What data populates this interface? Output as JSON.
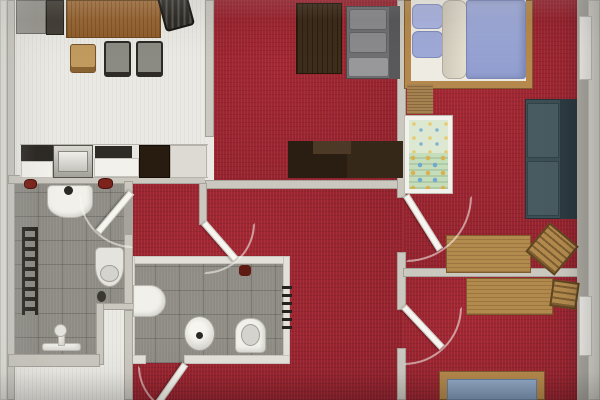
{
  "scene": {
    "type": "apartment-floor-plan-top-view",
    "canvas": {
      "w": 600,
      "h": 400
    },
    "palette": {
      "carpet_red": "#9c2430",
      "tile_gray": "#8e8c85",
      "floor_white": "#eae9e3",
      "wall": "#cbc8c0",
      "wood_light": "#b28a4e",
      "wood_dark": "#3f2d1b",
      "lavender_bedding": "#9ea9d7",
      "teal_sofa": "#3b4f55",
      "blue_mattress": "#8ba2bf"
    },
    "floors": [
      {
        "name": "kitchen-dining-floor",
        "cls": "floor-white",
        "x": 12,
        "y": 0,
        "w": 196,
        "h": 178
      },
      {
        "name": "living-room-floor",
        "cls": "carpet-red",
        "x": 208,
        "y": 0,
        "w": 195,
        "h": 183
      },
      {
        "name": "bedroom1-floor",
        "cls": "carpet-red",
        "x": 403,
        "y": 0,
        "w": 180,
        "h": 270
      },
      {
        "name": "bedroom2-floor",
        "cls": "carpet-red",
        "x": 403,
        "y": 270,
        "w": 180,
        "h": 130
      },
      {
        "name": "hallway-floor",
        "cls": "carpet-red",
        "x": 126,
        "y": 183,
        "w": 277,
        "h": 217
      },
      {
        "name": "bathroom-left-floor",
        "cls": "tile-gray",
        "x": 14,
        "y": 181,
        "w": 118,
        "h": 132
      },
      {
        "name": "shower-area-floor",
        "cls": "tile-gray",
        "x": 14,
        "y": 300,
        "w": 86,
        "h": 62
      },
      {
        "name": "closet-notch-floor",
        "cls": "floor-white",
        "x": 100,
        "y": 303,
        "w": 32,
        "h": 70
      },
      {
        "name": "entry-floor",
        "cls": "floor-white",
        "x": 0,
        "y": 366,
        "w": 126,
        "h": 34
      },
      {
        "name": "bathroom-mid-floor",
        "cls": "tile-gray",
        "x": 131,
        "y": 261,
        "w": 156,
        "h": 102
      }
    ],
    "walls": [
      {
        "name": "outer-wall-left-outer",
        "cls": "wall-light",
        "x": 0,
        "y": 0,
        "w": 7,
        "h": 400
      },
      {
        "name": "outer-wall-left-inner",
        "cls": "wall",
        "x": 7,
        "y": 0,
        "w": 8,
        "h": 400
      },
      {
        "name": "wall-kitchen-south",
        "cls": "wall",
        "x": 8,
        "y": 175,
        "w": 200,
        "h": 9
      },
      {
        "name": "wall-kitchen-living",
        "cls": "wall",
        "x": 205,
        "y": 0,
        "w": 9,
        "h": 137
      },
      {
        "name": "doorway-kitchen-living",
        "cls": "threshold",
        "x": 205,
        "y": 137,
        "w": 9,
        "h": 43
      },
      {
        "name": "wall-living-south",
        "cls": "wall",
        "x": 205,
        "y": 180,
        "w": 198,
        "h": 9
      },
      {
        "name": "wall-right-vert-a",
        "cls": "wall",
        "x": 397,
        "y": 0,
        "w": 9,
        "h": 198
      },
      {
        "name": "wall-right-vert-b",
        "cls": "wall",
        "x": 397,
        "y": 252,
        "w": 9,
        "h": 58
      },
      {
        "name": "wall-right-vert-c",
        "cls": "wall",
        "x": 397,
        "y": 348,
        "w": 9,
        "h": 52
      },
      {
        "name": "wall-bedrooms-divider",
        "cls": "wall",
        "x": 403,
        "y": 268,
        "w": 177,
        "h": 9
      },
      {
        "name": "outer-wall-right-inner",
        "cls": "wall-dark",
        "x": 577,
        "y": 0,
        "w": 11,
        "h": 400
      },
      {
        "name": "outer-wall-right-outer",
        "cls": "wall-light",
        "x": 588,
        "y": 0,
        "w": 12,
        "h": 400
      },
      {
        "name": "window-right-1",
        "cls": "window",
        "x": 579,
        "y": 16,
        "w": 13,
        "h": 64
      },
      {
        "name": "window-right-2",
        "cls": "window",
        "x": 579,
        "y": 296,
        "w": 13,
        "h": 60
      },
      {
        "name": "wall-bathmid-top",
        "cls": "wall-light",
        "x": 128,
        "y": 256,
        "w": 162,
        "h": 8
      },
      {
        "name": "wall-bathmid-left",
        "cls": "wall-light",
        "x": 128,
        "y": 256,
        "w": 7,
        "h": 107
      },
      {
        "name": "wall-bathmid-right",
        "cls": "wall-light",
        "x": 283,
        "y": 256,
        "w": 7,
        "h": 107
      },
      {
        "name": "wall-bathmid-bottom-l",
        "cls": "wall-light",
        "x": 128,
        "y": 355,
        "w": 18,
        "h": 9
      },
      {
        "name": "wall-bathmid-bottom-r",
        "cls": "wall-light",
        "x": 184,
        "y": 355,
        "w": 106,
        "h": 9
      },
      {
        "name": "doorway-bathleft",
        "cls": "threshold-gray",
        "x": 124,
        "y": 193,
        "w": 9,
        "h": 41
      },
      {
        "name": "wall-bathleft-right-a",
        "cls": "wall",
        "x": 124,
        "y": 181,
        "w": 9,
        "h": 12
      },
      {
        "name": "wall-bathleft-right-b",
        "cls": "wall",
        "x": 124,
        "y": 234,
        "w": 9,
        "h": 76
      },
      {
        "name": "wall-notch-top",
        "cls": "wall",
        "x": 96,
        "y": 303,
        "w": 38,
        "h": 7
      },
      {
        "name": "wall-notch-left",
        "cls": "wall",
        "x": 96,
        "y": 303,
        "w": 8,
        "h": 62
      },
      {
        "name": "wall-notch-right",
        "cls": "wall",
        "x": 124,
        "y": 310,
        "w": 9,
        "h": 90
      },
      {
        "name": "wall-shower-south",
        "cls": "wall",
        "x": 8,
        "y": 354,
        "w": 92,
        "h": 13
      },
      {
        "name": "wall-vestibule",
        "cls": "wall",
        "x": 199,
        "y": 183,
        "w": 8,
        "h": 42
      }
    ],
    "furniture": [
      {
        "name": "sideboard-gray",
        "cls": "unit-gray",
        "x": 16,
        "y": 0,
        "w": 30,
        "h": 34
      },
      {
        "name": "sideboard-dark",
        "cls": "unit-dark",
        "x": 46,
        "y": 0,
        "w": 18,
        "h": 35
      },
      {
        "name": "dining-table",
        "cls": "wood-grain",
        "x": 66,
        "y": 0,
        "w": 95,
        "h": 38
      },
      {
        "name": "dining-chair-wood",
        "cls": "chair-wood",
        "x": 70,
        "y": 44,
        "w": 26,
        "h": 29
      },
      {
        "name": "dining-chair-gray-1",
        "cls": "chair-gray",
        "x": 104,
        "y": 41,
        "w": 27,
        "h": 36
      },
      {
        "name": "dining-chair-gray-2",
        "cls": "chair-gray",
        "x": 136,
        "y": 41,
        "w": 27,
        "h": 36
      },
      {
        "name": "dining-chair-dark",
        "cls": "chair-dark",
        "x": 158,
        "y": -4,
        "w": 36,
        "h": 30,
        "rot": 75
      },
      {
        "name": "kitchen-counter-base",
        "cls": "counter-base",
        "x": 20,
        "y": 144,
        "w": 188,
        "h": 34
      },
      {
        "name": "kitchen-counter-dark",
        "cls": "counter-dark",
        "x": 21,
        "y": 145,
        "w": 32,
        "h": 16
      },
      {
        "name": "kitchen-cabinet-front-a",
        "cls": "cabinet-white",
        "x": 21,
        "y": 161,
        "w": 32,
        "h": 17
      },
      {
        "name": "kitchen-sink",
        "cls": "sink-steel",
        "x": 53,
        "y": 145,
        "w": 40,
        "h": 33
      },
      {
        "name": "kitchen-sink-basin",
        "cls": "sink-inner",
        "x": 58,
        "y": 151,
        "w": 30,
        "h": 21
      },
      {
        "name": "kitchen-cooktop",
        "cls": "counter-dark",
        "x": 95,
        "y": 146,
        "w": 37,
        "h": 12
      },
      {
        "name": "kitchen-cabinet-front-b",
        "cls": "cabinet-white",
        "x": 94,
        "y": 158,
        "w": 45,
        "h": 19
      },
      {
        "name": "kitchen-tall-unit",
        "cls": "unit-brown",
        "x": 139,
        "y": 145,
        "w": 31,
        "h": 33
      },
      {
        "name": "kitchen-counter-end",
        "cls": "counter-end",
        "x": 170,
        "y": 145,
        "w": 37,
        "h": 33
      },
      {
        "name": "coffee-table",
        "cls": "wood-dark",
        "x": 296,
        "y": 3,
        "w": 46,
        "h": 71
      },
      {
        "name": "sofa-base",
        "cls": "sofa-gray",
        "x": 346,
        "y": 6,
        "w": 54,
        "h": 73
      },
      {
        "name": "sofa-backrest",
        "cls": "sofa-gray-dark",
        "x": 389,
        "y": 6,
        "w": 11,
        "h": 73
      },
      {
        "name": "sofa-cushion-1",
        "cls": "sofa-cushion",
        "x": 349,
        "y": 9,
        "w": 38,
        "h": 21
      },
      {
        "name": "sofa-cushion-2",
        "cls": "sofa-cushion",
        "x": 349,
        "y": 32,
        "w": 38,
        "h": 21
      },
      {
        "name": "sofa-armrest",
        "cls": "sofa-cushion-light",
        "x": 348,
        "y": 57,
        "w": 41,
        "h": 20
      },
      {
        "name": "tv-cabinet-left",
        "cls": "unit-espresso",
        "x": 288,
        "y": 141,
        "w": 59,
        "h": 37
      },
      {
        "name": "tv-cabinet-right",
        "cls": "unit-espresso2",
        "x": 347,
        "y": 141,
        "w": 56,
        "h": 37
      },
      {
        "name": "tv-cabinet-step",
        "cls": "unit-espresso3",
        "x": 313,
        "y": 141,
        "w": 38,
        "h": 13
      },
      {
        "name": "bed1-frame",
        "cls": "bed-frame",
        "x": 404,
        "y": 0,
        "w": 129,
        "h": 89
      },
      {
        "name": "bed1-interior",
        "cls": "bed-interior",
        "x": 411,
        "y": 0,
        "w": 115,
        "h": 81
      },
      {
        "name": "bed1-pillow-1",
        "cls": "pillow-lavender",
        "x": 412,
        "y": 4,
        "w": 31,
        "h": 25,
        "rad": "6px"
      },
      {
        "name": "bed1-pillow-2",
        "cls": "pillow-lavender2",
        "x": 412,
        "y": 31,
        "w": 31,
        "h": 27,
        "rad": "6px"
      },
      {
        "name": "bed1-duvet-roll",
        "cls": "bedding-cream",
        "x": 442,
        "y": 0,
        "w": 25,
        "h": 79,
        "rad": "8px"
      },
      {
        "name": "bed1-mattress",
        "cls": "mattress-lavender",
        "x": 466,
        "y": 0,
        "w": 60,
        "h": 79,
        "rad": "3px"
      },
      {
        "name": "door-threshold-wood",
        "cls": "wood-grain2",
        "x": 407,
        "y": 84,
        "w": 26,
        "h": 30
      },
      {
        "name": "crib-frame",
        "cls": "crib-frame",
        "x": 404,
        "y": 115,
        "w": 49,
        "h": 79
      },
      {
        "name": "crib-pillow",
        "cls": "crib-fabric-light",
        "x": 409,
        "y": 120,
        "w": 39,
        "h": 33
      },
      {
        "name": "crib-blanket",
        "cls": "crib-fabric",
        "x": 409,
        "y": 153,
        "w": 39,
        "h": 36
      },
      {
        "name": "teal-sofa-base",
        "cls": "sofa-teal",
        "x": 525,
        "y": 99,
        "w": 52,
        "h": 120
      },
      {
        "name": "teal-sofa-backrest",
        "cls": "sofa-teal-dark",
        "x": 560,
        "y": 99,
        "w": 17,
        "h": 120
      },
      {
        "name": "teal-sofa-cushion-1",
        "cls": "sofa-teal-cushion",
        "x": 527,
        "y": 103,
        "w": 32,
        "h": 55
      },
      {
        "name": "teal-sofa-cushion-2",
        "cls": "sofa-teal-cushion",
        "x": 527,
        "y": 161,
        "w": 32,
        "h": 55
      },
      {
        "name": "desk-bedroom1",
        "cls": "wood-desk",
        "x": 446,
        "y": 235,
        "w": 85,
        "h": 38
      },
      {
        "name": "desk-chair-bedroom1",
        "cls": "chair-wood-slats",
        "x": 533,
        "y": 230,
        "w": 38,
        "h": 38,
        "rot": 40
      },
      {
        "name": "desk-bedroom2",
        "cls": "wood-desk",
        "x": 466,
        "y": 278,
        "w": 87,
        "h": 37
      },
      {
        "name": "desk-chair-bedroom2",
        "cls": "chair-wood-slats",
        "x": 551,
        "y": 281,
        "w": 27,
        "h": 27,
        "rot": 8
      },
      {
        "name": "bed2-frame",
        "cls": "bed-frame",
        "x": 439,
        "y": 371,
        "w": 106,
        "h": 29
      },
      {
        "name": "bed2-mattress",
        "cls": "mattress-blue",
        "x": 447,
        "y": 379,
        "w": 90,
        "h": 21
      }
    ],
    "fixtures": [
      {
        "name": "hallway-radiator",
        "cls": "radiator-ticks",
        "x": 282,
        "y": 286,
        "w": 10,
        "h": 48
      },
      {
        "name": "wall-object-red-1",
        "cls": "obj-red",
        "x": 24,
        "y": 179,
        "w": 13,
        "h": 10,
        "rad": "40%"
      },
      {
        "name": "wall-object-red-2",
        "cls": "obj-red",
        "x": 98,
        "y": 178,
        "w": 15,
        "h": 11,
        "rad": "40%"
      },
      {
        "name": "bathmid-wall-object",
        "cls": "obj-red-dark",
        "x": 239,
        "y": 265,
        "w": 12,
        "h": 11,
        "rad": "30%"
      },
      {
        "name": "bathmid-bidet",
        "cls": "fixture-white",
        "x": 133,
        "y": 285,
        "w": 33,
        "h": 32,
        "rad": "0 16px 16px 0"
      },
      {
        "name": "bathmid-basin",
        "cls": "basin-round",
        "x": 184,
        "y": 316,
        "w": 31,
        "h": 35,
        "rad": "50%"
      },
      {
        "name": "bathmid-basin-drain",
        "cls": "drain-dot",
        "x": 196,
        "y": 332,
        "w": 7,
        "h": 7
      },
      {
        "name": "bathmid-toilet",
        "cls": "fixture-white",
        "x": 235,
        "y": 318,
        "w": 31,
        "h": 35,
        "rad": "14px 14px 5px 5px"
      },
      {
        "name": "bathmid-toilet-bowl",
        "cls": "fixture-inner",
        "x": 241,
        "y": 324,
        "w": 19,
        "h": 22,
        "rad": "50%"
      },
      {
        "name": "bathleft-washbasin",
        "cls": "fixture-white",
        "x": 47,
        "y": 185,
        "w": 46,
        "h": 33,
        "rad": "5px 5px 45% 45%"
      },
      {
        "name": "bathleft-basin-faucet",
        "cls": "drain-dot",
        "x": 64,
        "y": 186,
        "w": 9,
        "h": 9
      },
      {
        "name": "bathleft-towel-radiator",
        "cls": "towel-rungs",
        "x": 22,
        "y": 227,
        "w": 16,
        "h": 88
      },
      {
        "name": "bathleft-toilet",
        "cls": "fixture-light",
        "x": 95,
        "y": 247,
        "w": 29,
        "h": 40,
        "rad": "5px 5px 50% 50%"
      },
      {
        "name": "bathleft-toilet-bowl",
        "cls": "fixture-inner",
        "x": 100,
        "y": 265,
        "w": 19,
        "h": 17,
        "rad": "50%"
      },
      {
        "name": "bathleft-toilet-brush",
        "cls": "obj-dark",
        "x": 97,
        "y": 291,
        "w": 9,
        "h": 11,
        "rad": "50%"
      },
      {
        "name": "shower-bar",
        "cls": "fixture-white",
        "x": 42,
        "y": 343,
        "w": 39,
        "h": 8,
        "rad": "3px"
      },
      {
        "name": "shower-stem",
        "cls": "fixture-white",
        "x": 58,
        "y": 328,
        "w": 7,
        "h": 18
      },
      {
        "name": "shower-head",
        "cls": "fixture-light",
        "x": 54,
        "y": 324,
        "w": 13,
        "h": 13,
        "rad": "50%"
      }
    ],
    "doors": [
      {
        "name": "door-bathroom-left",
        "hx": 129,
        "hy": 194,
        "len": 50,
        "angle": 130,
        "quad": "bl"
      },
      {
        "name": "door-vestibule",
        "hx": 204,
        "hy": 223,
        "len": 47,
        "angle": 49,
        "quad": "br"
      },
      {
        "name": "door-bedroom1",
        "hx": 406,
        "hy": 196,
        "len": 62,
        "angle": 58,
        "quad": "br"
      },
      {
        "name": "door-bedroom2",
        "hx": 404,
        "hy": 307,
        "len": 54,
        "angle": 47,
        "quad": "br"
      },
      {
        "name": "door-bathroom-mid",
        "hx": 183,
        "hy": 366,
        "len": 45,
        "angle": 125,
        "quad": "bl"
      }
    ]
  }
}
